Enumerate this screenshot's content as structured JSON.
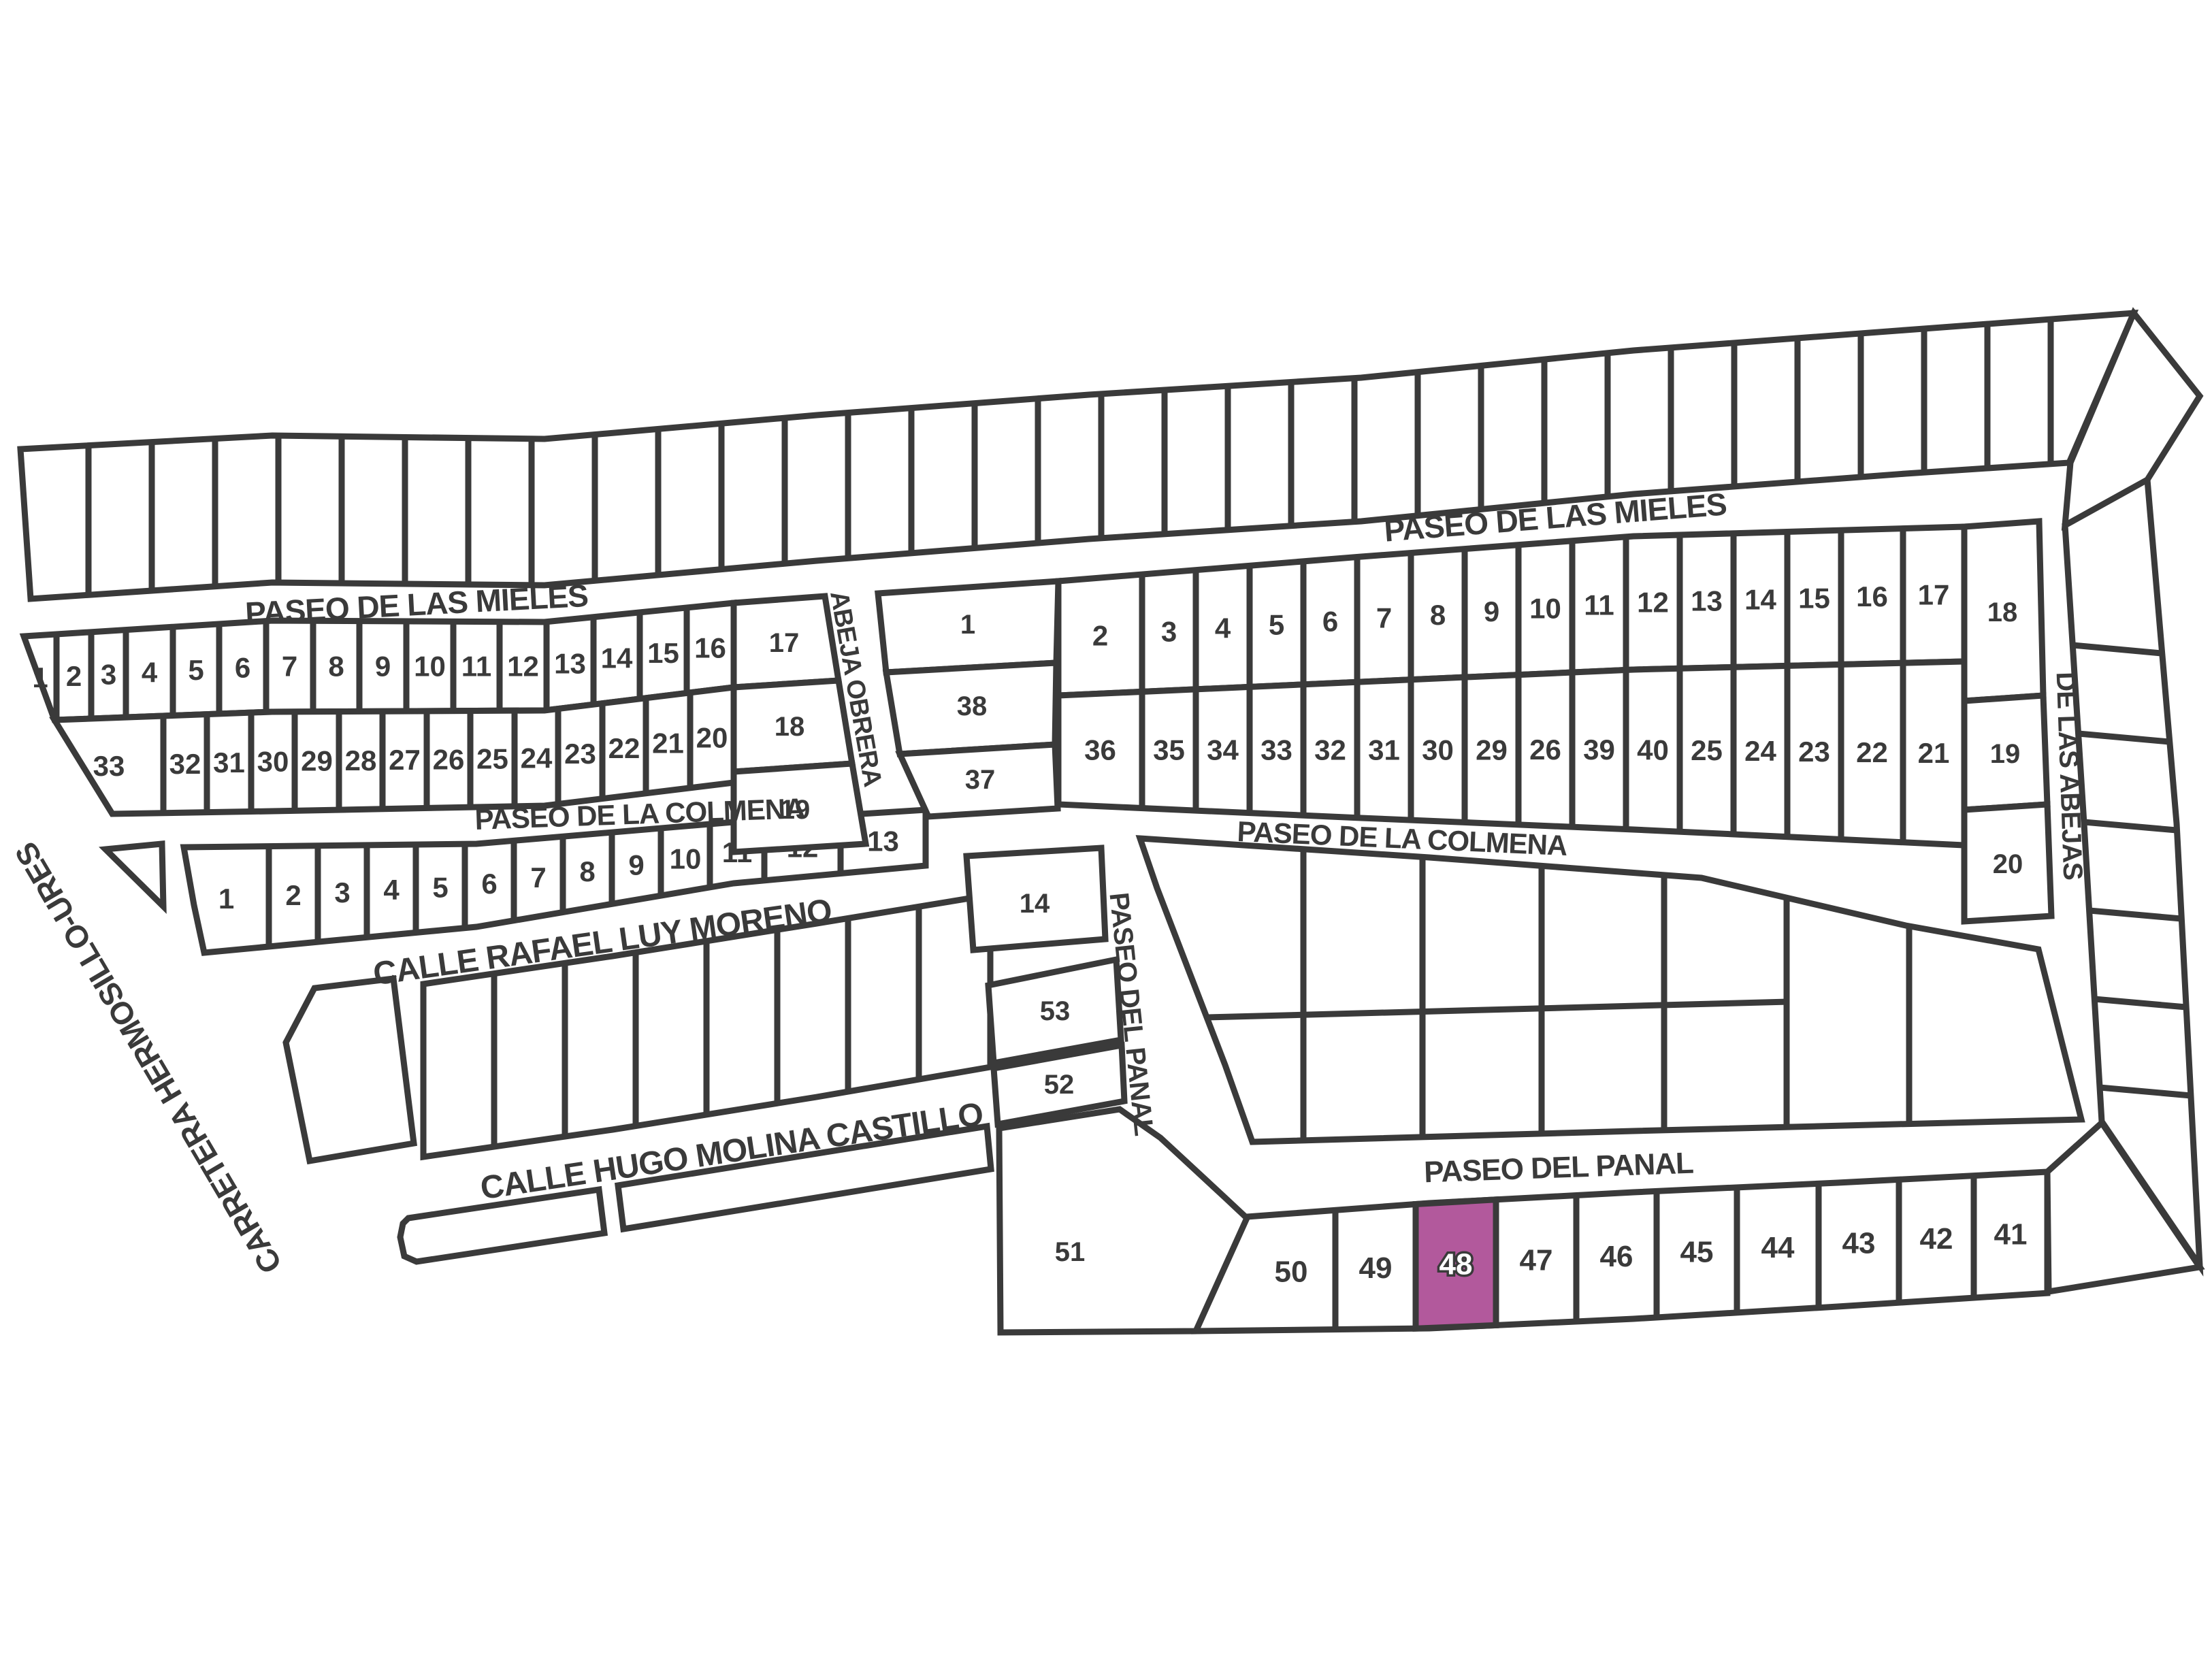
{
  "map": {
    "background": "#ffffff",
    "line_color": "#3a3a3a",
    "text_color": "#3a3a3a",
    "highlight": {
      "lot": "48",
      "fill": "#b2599c",
      "label_color": "#ffffff"
    },
    "streets": {
      "paseo_de_las_mieles": "PASEO DE LAS MIELES",
      "paseo_de_la_colmena": "PASEO DE LA COLMENA",
      "calle_rafael_luy_moreno": "CALLE RAFAEL LUY MORENO",
      "calle_hugo_molina_castillo": "CALLE HUGO MOLINA CASTILLO",
      "paseo_del_panal": "PASEO DEL PANAL",
      "abeja_obrera": "ABEJA OBRERA",
      "de_las_abejas": "DE LAS ABEJAS",
      "carretera_hermosillo_ures": "CARRETERA HERMOSILLO-URES"
    },
    "blocks": {
      "left_row_a": {
        "lots": [
          "1",
          "2",
          "3",
          "4",
          "5",
          "6",
          "7",
          "8",
          "9",
          "10",
          "11",
          "12",
          "13",
          "14",
          "15",
          "16"
        ]
      },
      "left_row_b": {
        "lots": [
          "33",
          "32",
          "31",
          "30",
          "29",
          "28",
          "27",
          "26",
          "25",
          "24",
          "23",
          "22",
          "21",
          "20"
        ]
      },
      "left_col_17_19": {
        "lots": [
          "17",
          "18",
          "19"
        ]
      },
      "colmena_south": {
        "lots": [
          "1",
          "2",
          "3",
          "4",
          "5",
          "6",
          "7",
          "8",
          "9",
          "10",
          "11",
          "12",
          "13"
        ]
      },
      "lot_14": {
        "lots": [
          "14"
        ]
      },
      "abeja_col": {
        "lots": [
          "1",
          "38",
          "37"
        ]
      },
      "right_row_a": {
        "lots": [
          "2",
          "3",
          "4",
          "5",
          "6",
          "7",
          "8",
          "9",
          "10",
          "11",
          "12",
          "13",
          "14",
          "15",
          "16",
          "17"
        ]
      },
      "right_row_b": {
        "lots": [
          "36",
          "35",
          "34",
          "33",
          "32",
          "31",
          "30",
          "29",
          "26",
          "39",
          "40",
          "25",
          "24",
          "23",
          "22",
          "21"
        ]
      },
      "right_col_18_20": {
        "lots": [
          "18",
          "19",
          "20"
        ]
      },
      "lots_53_52": {
        "lots": [
          "53",
          "52"
        ]
      },
      "lot_51": {
        "lots": [
          "51"
        ]
      },
      "panal_row": {
        "lots": [
          "50",
          "49",
          "48",
          "47",
          "46",
          "45",
          "44",
          "43",
          "42",
          "41"
        ]
      }
    }
  }
}
